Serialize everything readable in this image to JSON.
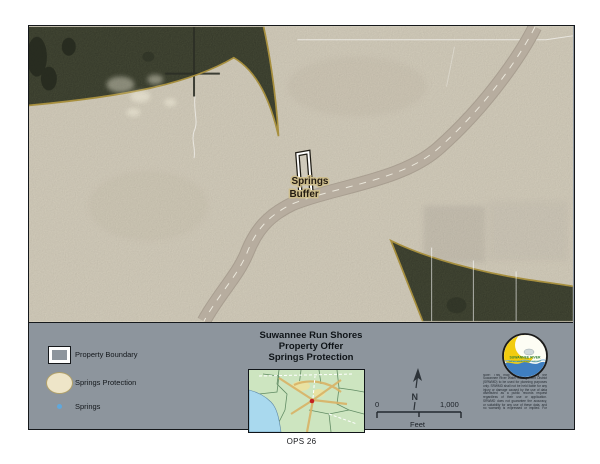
{
  "page": {
    "footer_label": "OPS 26"
  },
  "map": {
    "property_label": {
      "line1": "Springs",
      "line2": "Buffer"
    }
  },
  "panel": {
    "title": {
      "line1": "Suwannee Run Shores",
      "line2": "Property Offer",
      "line3": "Springs Protection"
    },
    "legend": {
      "items": [
        {
          "label": "Property Boundary"
        },
        {
          "label": "Springs Protection"
        },
        {
          "label": "Springs"
        }
      ]
    },
    "north_label": "N",
    "scalebar": {
      "start": "0",
      "end": "1,000",
      "unit": "Feet"
    },
    "disclaimer": "Note: This map was created by the Suwannee River Water Management District (SRWMD) to be used for planning purposes only. SRWMD shall not be held liable for any injury or damage caused by the use of data distributed as a public records request regardless of their use or application. SRWMD does not guarantee the accuracy, or suitability for any use of these data, and no warranty is expressed or implied. For more information please contact the SRWMD at 386.362.1001. Map Created 11/18/2020",
    "logo": {
      "text_top": "SUWANNEE RIVER",
      "text_bottom": "WATER MANAGEMENT DISTRICT"
    }
  },
  "colors": {
    "panel_bg": "#8d959d",
    "aerial_light": "#dcd5c3",
    "forest_dark": "#50553f",
    "protection_outline": "#a78f3e",
    "protection_fill": "#eee5c8",
    "springs_blue": "#5fa8dd",
    "highway_gray": "#b6ac9e",
    "inset_water": "#a9d9ee",
    "inset_land": "#cde5c0",
    "logo_yellow": "#f2cc0f",
    "logo_blue": "#3f7fc1"
  }
}
